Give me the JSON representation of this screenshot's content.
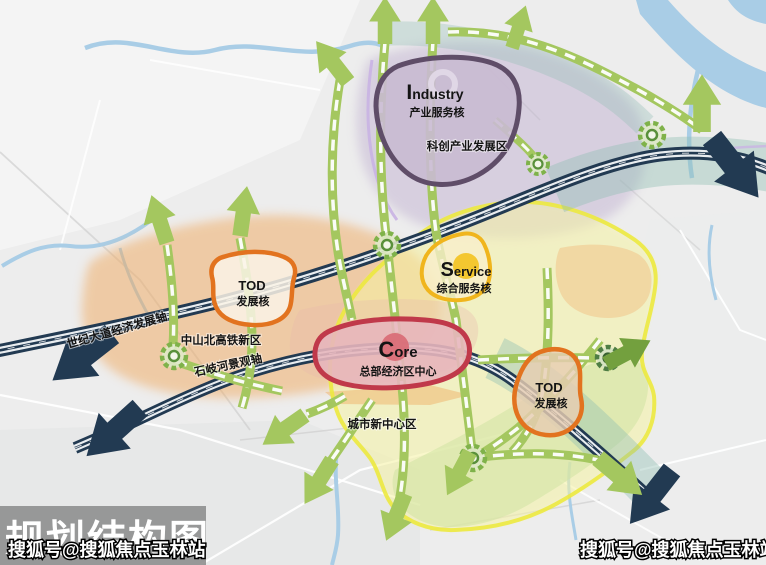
{
  "map_title": "规划结构图",
  "watermark": {
    "text": "搜狐号@搜狐焦点玉林站"
  },
  "cores": {
    "industry": {
      "initial": "I",
      "rest": "ndustry",
      "zh": "产业服务核"
    },
    "service": {
      "initial": "S",
      "rest": "ervice",
      "zh": "综合服务核"
    },
    "core": {
      "initial": "C",
      "rest": "ore",
      "zh": "总部经济区中心"
    },
    "tod_west": {
      "label": "TOD",
      "zh": "发展核"
    },
    "tod_east": {
      "label": "TOD",
      "zh": "发展核"
    }
  },
  "labels": {
    "kechuang": "科创产业发展区",
    "shiji_axis": "世纪大道经济发展轴",
    "zhongshan": "中山北高铁新区",
    "shiqi_axis": "石岐河景观轴",
    "chengshi": "城市新中心区"
  },
  "colors": {
    "navy_band": "#223a52",
    "green_axis": "#a4c75f",
    "green_dark": "#73a03e",
    "orange_core_border": "#e2731f",
    "red_core_border": "#c0394a",
    "yellow_core_border": "#f0b51d",
    "purple_core_border": "#5f4d68",
    "yellow_zone_border": "#ece93f",
    "orange_zone_fill": "#f0a95f",
    "yellow_zone_fill": "#f6f3a2",
    "green_zone_fill": "#cfe3a3",
    "purple_zone_fill": "#b9a7cc",
    "teal_band": "#8fbdb2",
    "river": "#a9cde6",
    "title_bg": "#8c8c8c",
    "watermark_fill": "#ffffff"
  }
}
